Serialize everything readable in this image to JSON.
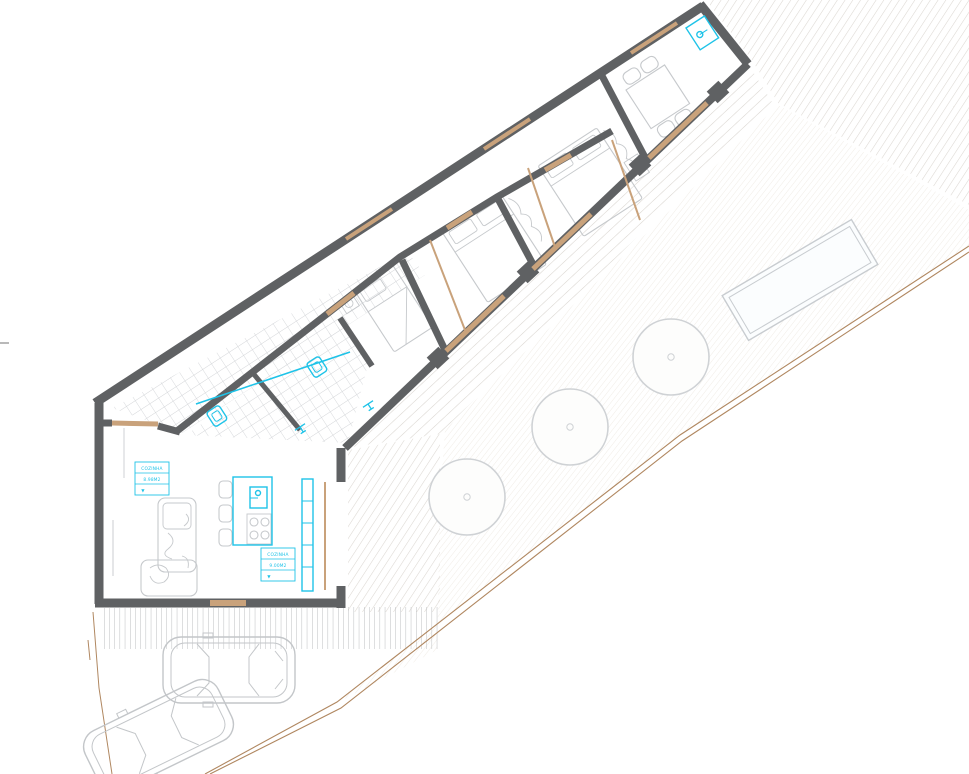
{
  "drawing": {
    "type": "architectural-floor-plan",
    "room_labels": [
      {
        "name": "COZINHA",
        "area": "8.98M2",
        "symbol": "▼"
      },
      {
        "name": "COZINHA",
        "area": "9.00M2",
        "symbol": "▼"
      }
    ],
    "colors": {
      "wall": "#5f6163",
      "furniture_line": "#c6c9cc",
      "fixture_cyan": "#1ec3e8",
      "opening_tan": "#c9a27b",
      "boundary_tan": "#b08760",
      "tile_line": "#d3d5d8",
      "hatch_line": "#dbd7d1",
      "lawn_line": "#f0ede7",
      "step_line": "#b5b8ba"
    },
    "symbols": [
      "single-bed",
      "double-bed",
      "dining-table-with-chairs",
      "sofa",
      "kitchen-island-with-hob",
      "bar-stool",
      "toilet",
      "washbasin",
      "water-heater",
      "glass-sliding-door",
      "tree",
      "swimming-pool",
      "car",
      "deck-hatch",
      "tiled-floor",
      "plot-boundary"
    ]
  }
}
